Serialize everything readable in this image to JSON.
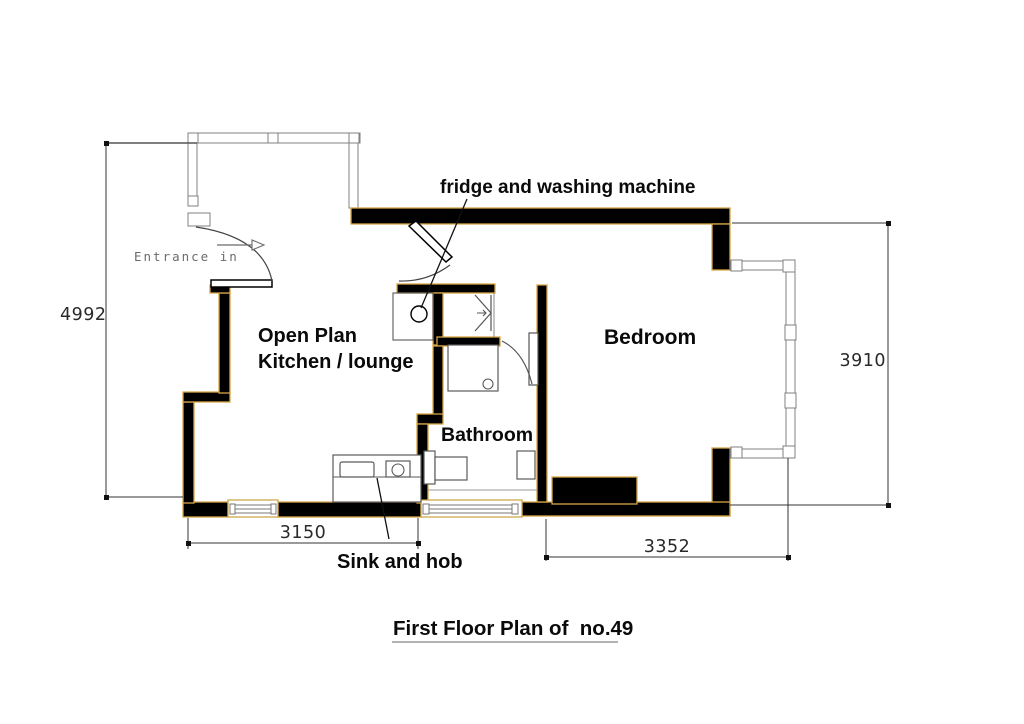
{
  "drawing": {
    "title": "First Floor Plan of  no.49",
    "rooms": {
      "open_plan_line1": "Open Plan",
      "open_plan_line2": "Kitchen / lounge",
      "bedroom": "Bedroom",
      "bathroom": "Bathroom"
    },
    "annotations": {
      "appliances": "fridge and washing machine",
      "sink_and_hob": "Sink and hob",
      "entrance": "Entrance in"
    },
    "dimensions": {
      "overall_height": "4992",
      "bedroom_height": "3910",
      "kitchen_width": "3150",
      "bedroom_width": "3352"
    },
    "colors": {
      "wall_fill": "#000000",
      "wall_edge": "#d7a648",
      "thin_line": "#808080",
      "dimension_line": "#333333"
    }
  }
}
